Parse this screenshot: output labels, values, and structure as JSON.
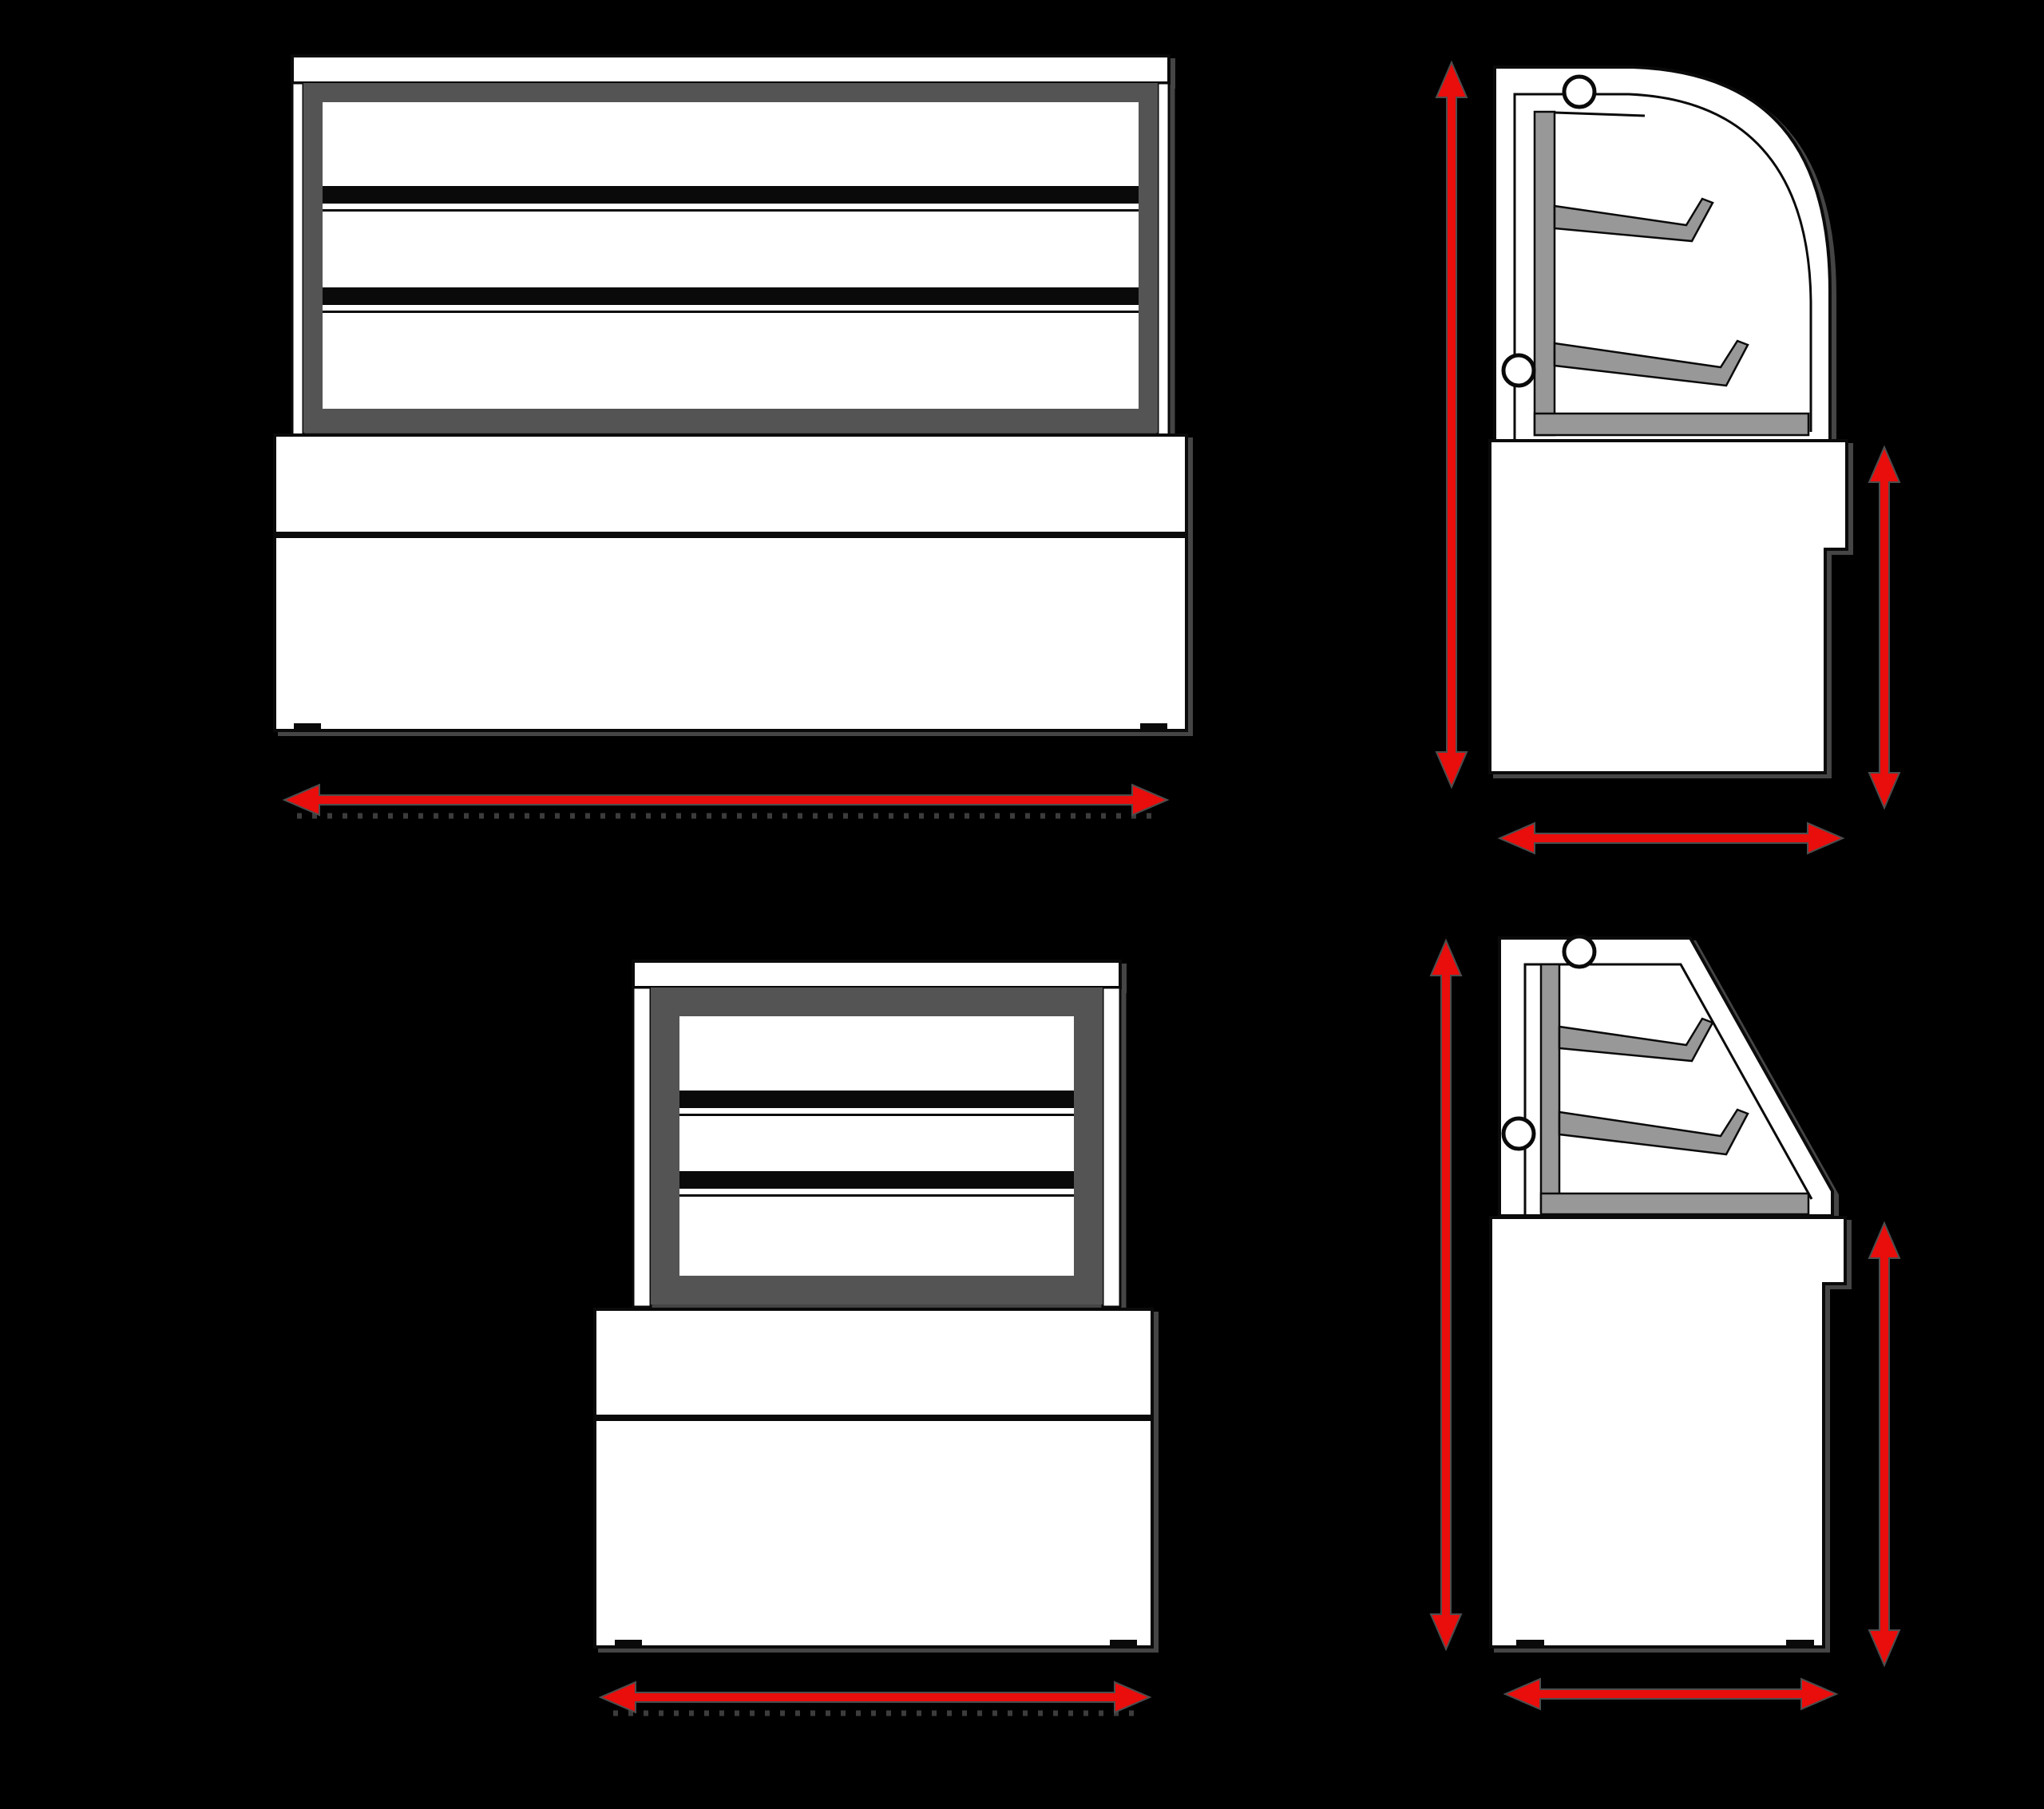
{
  "title": "",
  "diagram": {
    "kind": "technical-dimension-drawing",
    "subject": "curved-and-flat-glass bakery display cabinets, four orthographic views on black background",
    "visible_text": "none",
    "views": {
      "front_wide": {
        "position": "top-left",
        "shelf_rows": 3,
        "parts": [
          "top-canopy",
          "side-pillars",
          "display-frame",
          "shelf-bars",
          "two-section-base",
          "feet-ticks"
        ],
        "dimension_arrows": [
          {
            "orientation": "horizontal",
            "meaning": "overall width"
          }
        ]
      },
      "side_curved": {
        "position": "top-right",
        "glass": "curved",
        "shelves": 2,
        "parts": [
          "left-wall",
          "curved-glass-front",
          "back-panel",
          "shelf-brackets",
          "bottom-deck",
          "notched-base",
          "hinge-knobs"
        ],
        "dimension_arrows": [
          {
            "orientation": "vertical",
            "meaning": "overall height"
          },
          {
            "orientation": "vertical",
            "meaning": "base height"
          },
          {
            "orientation": "horizontal",
            "meaning": "overall depth"
          }
        ]
      },
      "front_narrow": {
        "position": "bottom-left",
        "shelf_rows": 3,
        "parts": [
          "top-canopy",
          "side-pillars",
          "display-frame",
          "shelf-bars",
          "two-section-base",
          "feet-ticks"
        ],
        "dimension_arrows": [
          {
            "orientation": "horizontal",
            "meaning": "overall width"
          }
        ]
      },
      "side_flat": {
        "position": "bottom-right",
        "glass": "flat-slanted",
        "shelves": 2,
        "parts": [
          "left-wall",
          "slanted-glass-front",
          "back-panel",
          "shelf-brackets",
          "bottom-deck",
          "notched-base",
          "feet-ticks",
          "hinge-knobs"
        ],
        "dimension_arrows": [
          {
            "orientation": "vertical",
            "meaning": "overall height"
          },
          {
            "orientation": "vertical",
            "meaning": "base height"
          },
          {
            "orientation": "horizontal",
            "meaning": "overall depth"
          }
        ]
      }
    }
  },
  "colors": {
    "background": "#000000",
    "outline": "#0a0a0a",
    "surface_white": "#ffffff",
    "frame_gray": "#545454",
    "shelf_gray": "#989898",
    "dimension_red": "#e90d0c",
    "arrow_outline": "#4d4d4d",
    "dotted_gray": "#3c3c3c"
  }
}
